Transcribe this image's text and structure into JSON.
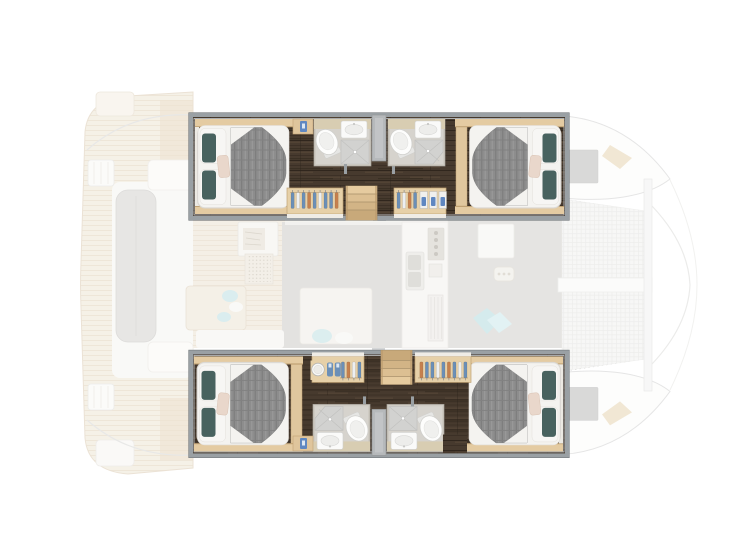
{
  "regions": {
    "boat": "Catamaran interior deck plan, bow to the right",
    "hull_port": "Port hull (top), highlighted: aft and forward double cabins, two en-suite shower rooms, wardrobes and companionway steps",
    "hull_starboard": "Starboard hull (bottom), highlighted: aft and forward double cabins, two en-suite shower rooms, wardrobes and companionway steps",
    "cabin_aft": "Aft double cabin with island berth",
    "cabin_forward": "Forward double cabin with island berth",
    "bathroom": "En-suite shower room with toilet, basin and shower",
    "wardrobe": "Hanging wardrobe with shelves",
    "stairs": "Companionway steps to saloon",
    "nightstand": "Bedside locker",
    "saloon": "Saloon with galley, nav station and seating (faded)",
    "cockpit": "Aft cockpit with lounge seating and swim platforms (faded)",
    "foredeck": "Foredeck with trampolines, catwalk and bow hatches (faded)"
  },
  "colors": {
    "background": "#ffffff",
    "frame_gray": "#9aa0a4",
    "frame_dark": "#74797d",
    "floor_dark_wood": "#473a2e",
    "floor_wood_streak": "#5c4c3b",
    "oak_light": "#e4cba2",
    "oak_trim_edge": "#bfa173",
    "bed_white": "#f4f3f0",
    "duvet_gray": "#8d8d8d",
    "pillow_teal": "#48625f",
    "pillow_blush": "#e9d7cb",
    "bath_wall": "#cfcbc3",
    "bath_counter": "#d8cdb2",
    "shower_gray": "#d2d2d0",
    "fixture_white": "#fdfdfc",
    "hanger_blue": "#6b8fb7",
    "hanger_orange": "#c5804e",
    "shelf_blue": "#5f87c1",
    "divider_gray": "#b6b9bb",
    "stair_wood": "#dfc296",
    "faded_deck": "#f2ecdf",
    "faded_deck_line": "#e4d6c2",
    "faded_gray_floor": "#d9d8d5",
    "faded_teal": "#c6e4e7",
    "net_base": "#f4f4f3",
    "net_grid": "#e7e7e5",
    "hatch_gray": "#cbcbca"
  }
}
